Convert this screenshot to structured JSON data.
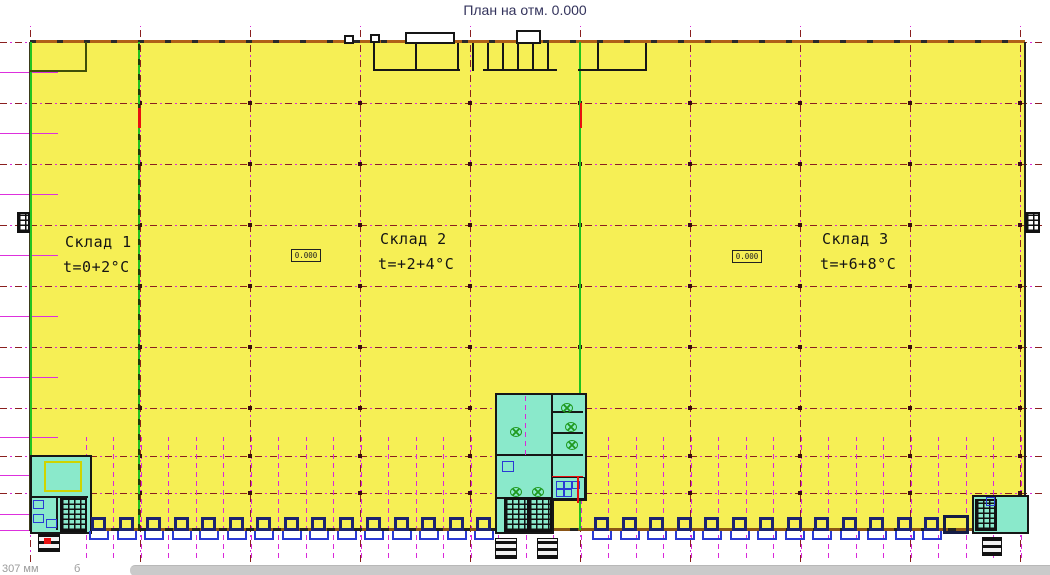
{
  "title": "План на отм. 0.000",
  "warehouses": [
    {
      "name": "Склад 1",
      "temp": "t=0+2°C"
    },
    {
      "name": "Склад 2",
      "temp": "t=+2+4°C"
    },
    {
      "name": "Склад 3",
      "temp": "t=+6+8°C"
    }
  ],
  "elevation_markers": [
    "0.000",
    "0.000"
  ],
  "statusbar": {
    "left_text": "307 мм",
    "right_text": "б"
  },
  "dock_doors": {
    "left_group_count": 15,
    "right_group_count": 13
  },
  "colors": {
    "plan_fill": "#f6ef55",
    "room_fill": "#8ae9cb",
    "axis_magenta": "#d928d9",
    "axis_dark": "#8a1f1f",
    "divider_green": "#1ec31e",
    "wall_orange": "#b06018",
    "door_navy": "#1c2370",
    "dock_blue": "#2a3ad4",
    "alert_red": "#e81010",
    "title_color": "#33335c"
  }
}
